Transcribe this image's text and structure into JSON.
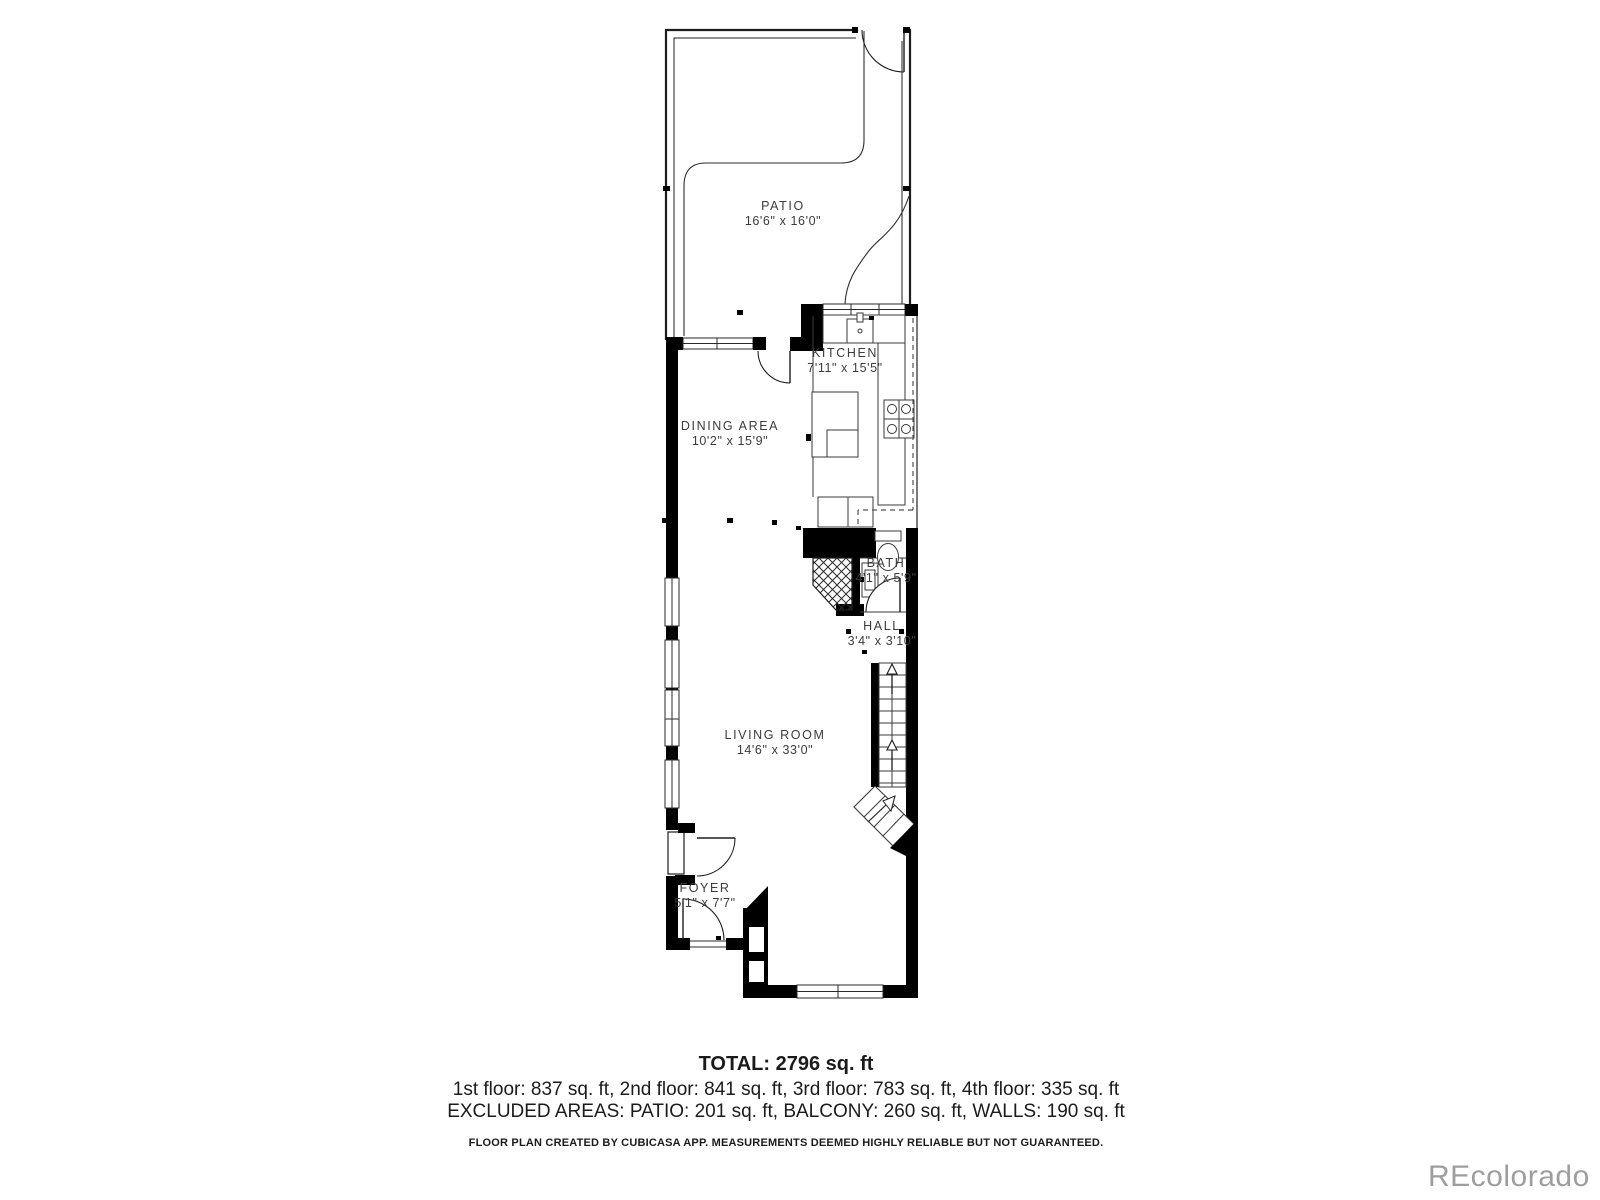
{
  "plan": {
    "rooms": [
      {
        "name": "PATIO",
        "dims": "16'6\" x 16'0\""
      },
      {
        "name": "KITCHEN",
        "dims": "7'11\" x 15'5\""
      },
      {
        "name": "DINING AREA",
        "dims": "10'2\" x 15'9\""
      },
      {
        "name": "BATH",
        "dims": "4'1\" x 5'9\""
      },
      {
        "name": "HALL",
        "dims": "3'4\" x 3'10\""
      },
      {
        "name": "LIVING ROOM",
        "dims": "14'6\" x 33'0\""
      },
      {
        "name": "FOYER",
        "dims": "5'1\" x 7'7\""
      }
    ]
  },
  "summary": {
    "total": "TOTAL: 2796 sq. ft",
    "floors": "1st floor: 837 sq. ft, 2nd floor: 841 sq. ft, 3rd floor: 783 sq. ft, 4th floor: 335 sq. ft",
    "excluded": "EXCLUDED AREAS: PATIO: 201 sq. ft, BALCONY: 260 sq. ft, WALLS: 190 sq. ft",
    "disclaimer": "FLOOR PLAN CREATED BY CUBICASA APP. MEASUREMENTS DEEMED HIGHLY RELIABLE BUT NOT GUARANTEED."
  },
  "watermark": "REcolorado",
  "colors": {
    "wall": "#000000",
    "line": "#2e2e2e",
    "text": "#3c3c3c",
    "watermark": "#9e9e9e"
  }
}
